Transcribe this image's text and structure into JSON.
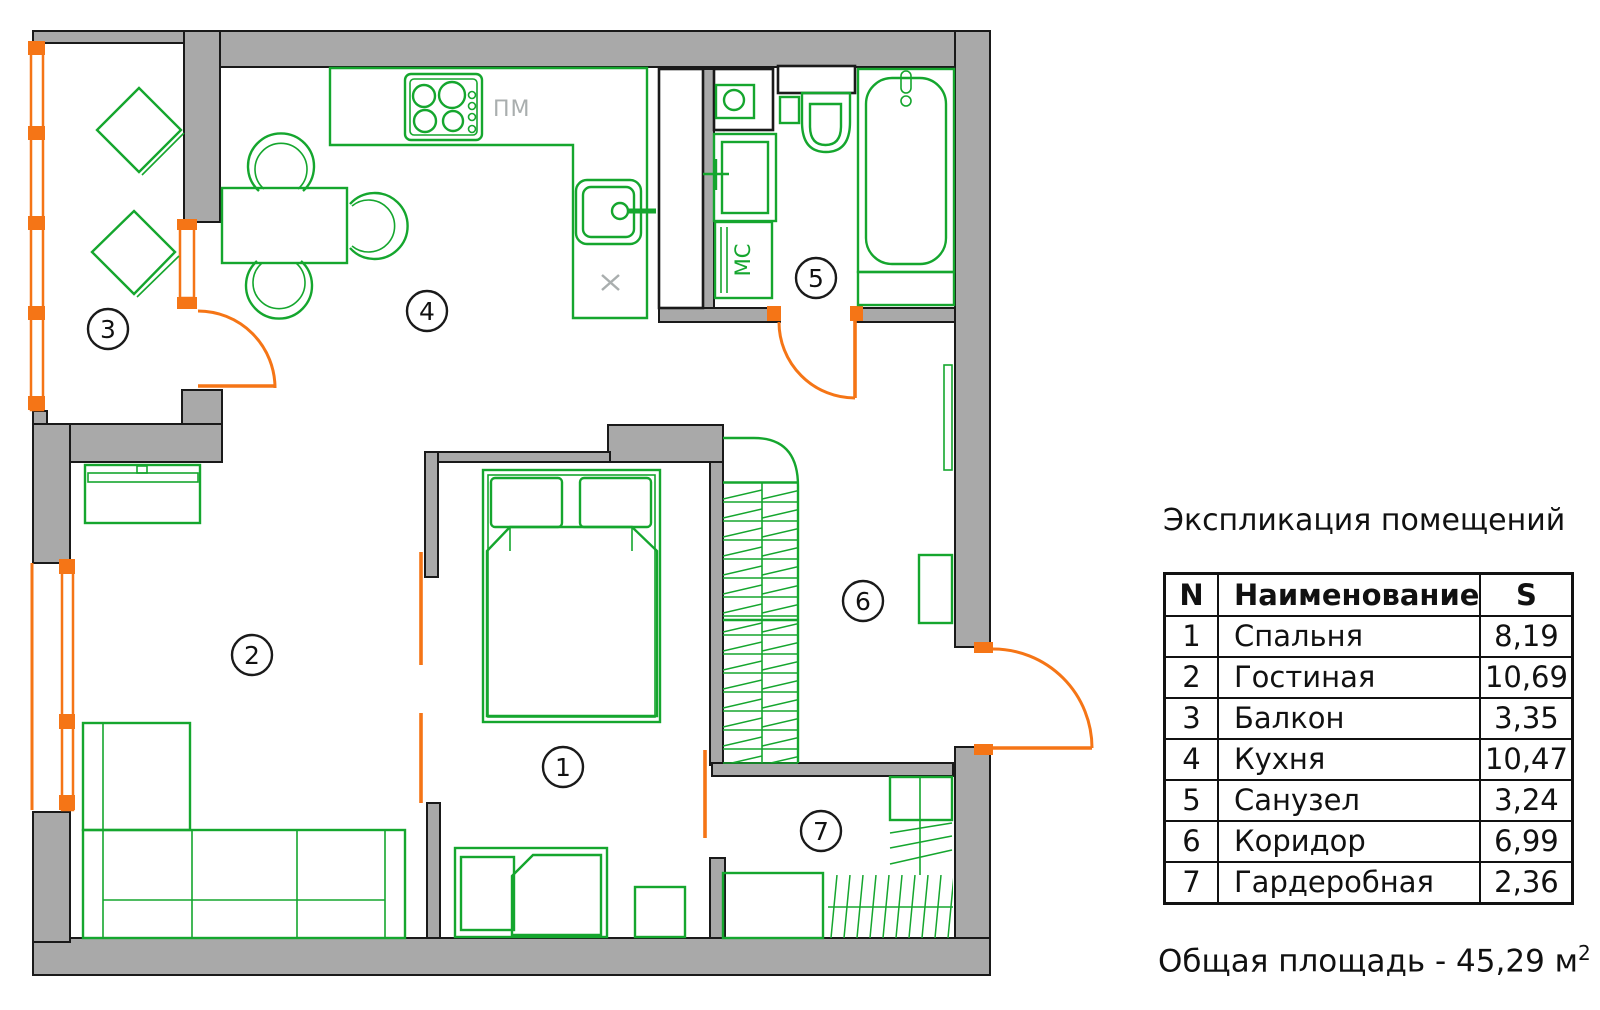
{
  "colors": {
    "wall_fill": "#a9a9a9",
    "wall_outline": "#1a1a1a",
    "furniture_green": "#15a62e",
    "door_orange": "#f57516",
    "muted_gray": "#a9aeae"
  },
  "plan": {
    "rooms": [
      {
        "num": "1"
      },
      {
        "num": "2"
      },
      {
        "num": "3"
      },
      {
        "num": "4"
      },
      {
        "num": "5"
      },
      {
        "num": "6"
      },
      {
        "num": "7"
      }
    ],
    "labels": {
      "dishwasher": "ПМ",
      "washing_machine": "МС"
    }
  },
  "legend": {
    "title": "Экспликация помещений",
    "columns": {
      "num": "N",
      "name": "Наименование",
      "area": "S"
    },
    "rows": [
      {
        "num": "1",
        "name": "Спальня",
        "area": "8,19"
      },
      {
        "num": "2",
        "name": "Гостиная",
        "area": "10,69"
      },
      {
        "num": "3",
        "name": "Балкон",
        "area": "3,35"
      },
      {
        "num": "4",
        "name": "Кухня",
        "area": "10,47"
      },
      {
        "num": "5",
        "name": "Санузел",
        "area": "3,24"
      },
      {
        "num": "6",
        "name": "Коридор",
        "area": "6,99"
      },
      {
        "num": "7",
        "name": "Гардеробная",
        "area": "2,36"
      }
    ],
    "total_label": "Общая площадь - 45,29 м",
    "total_sup": "2"
  }
}
